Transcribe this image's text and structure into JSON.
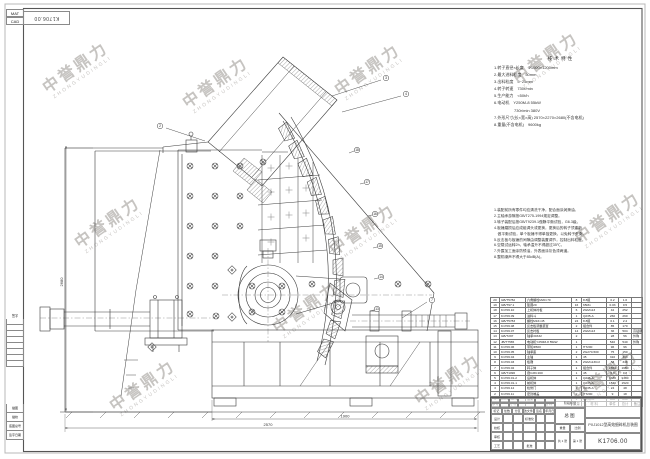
{
  "watermark": {
    "cn": "中誉鼎力",
    "en": "ZHONGYUDINGLI"
  },
  "corner": {
    "row1": "MAT",
    "row2": "CAD",
    "flipped_number": "K1706.00"
  },
  "left_margin": {
    "rev_label": "签字",
    "labels": [
      "描图",
      "描校",
      "底图总号",
      "签字日期"
    ]
  },
  "spec": {
    "title": "技术特性",
    "lines": [
      "1.转子直径×长度　Φ1000×1200mm",
      "2.最大进料粒度　50mm",
      "3.出料粒度　5~25mm",
      "4.转子转速　730r/min",
      "5.生产能力　<50t/h",
      "6.电动机　Y250M-8 55kW",
      "　　　　　730r/min  380V",
      "7.外形尺寸(长×宽×高) 2570×2270×2680(不含电机)",
      "8.重量(不含电机)　9600kg"
    ]
  },
  "notes": {
    "lines": [
      "1.装配前所有零件均应清洗干净，配合面涂润滑油。",
      "2.主轴承游隙按GB/T275-1994规定调整。",
      "3.转子装配后按GB/T9239.1做静平衡试验，G6.3级。",
      "4.板锤磨损后应成组调头或更换，更换后的转子须重新",
      "　做平衡试验，单个板锤不得单独更换，以免转子失衡。",
      "5.反击板与板锤的间隙由调整装置调节，控制出料粒度。",
      "6.空载试运转2h，轴承温升不得超过35℃。",
      "7.外露加工面涂防锈油，外表面涂灰色漆两道。",
      "8.整机噪声不得大于85dB(A)。"
    ]
  },
  "drawing": {
    "balloons": [
      "2",
      "3",
      "4",
      "18",
      "17",
      "16",
      "15",
      "14",
      "13",
      "7"
    ],
    "dims": {
      "height": "2680",
      "width": "2570",
      "inner": "1900"
    }
  },
  "bom": {
    "headers": [
      "序号",
      "代  号",
      "名  称",
      "数量",
      "材  料",
      "单件",
      "总计",
      "备注"
    ],
    "rows": [
      {
        "no": "20",
        "code": "GB/T5782",
        "name": "六角螺栓M20×70",
        "qty": "8",
        "mat": "8.8级",
        "uw": "0.2",
        "tw": "1.6",
        "rem": ""
      },
      {
        "no": "19",
        "code": "GB/T97.1",
        "name": "垫圈20",
        "qty": "16",
        "mat": "65Mn",
        "uw": "0.03",
        "tw": "0.5",
        "rem": ""
      },
      {
        "no": "18",
        "code": "K1706.10",
        "name": "上机体衬板",
        "qty": "6",
        "mat": "ZGMn13",
        "uw": "42",
        "tw": "252",
        "rem": ""
      },
      {
        "no": "17",
        "code": "K1706.09",
        "name": "进料斗",
        "qty": "1",
        "mat": "Q235-A",
        "uw": "260",
        "tw": "260",
        "rem": ""
      },
      {
        "no": "16",
        "code": "GB/T5783",
        "name": "螺栓M16×45",
        "qty": "24",
        "mat": "8.8级",
        "uw": "0.1",
        "tw": "2.4",
        "rem": ""
      },
      {
        "no": "15",
        "code": "K1706.08",
        "name": "反击板调整装置",
        "qty": "2",
        "mat": "组合件",
        "uw": "85",
        "tw": "170",
        "rem": ""
      },
      {
        "no": "14",
        "code": "K1706.07",
        "name": "反击衬板",
        "qty": "14",
        "mat": "ZGMn13",
        "uw": "36",
        "tw": "504",
        "rem": "高锰钢"
      },
      {
        "no": "13",
        "code": "GB/T297",
        "name": "轴承30332",
        "qty": "2",
        "mat": "",
        "uw": "28",
        "tw": "56",
        "rem": "外购"
      },
      {
        "no": "12",
        "code": "JB/T7565",
        "name": "电动机Y250M-8 55kW",
        "qty": "1",
        "mat": "",
        "uw": "540",
        "tw": "540",
        "rem": "外购"
      },
      {
        "no": "11",
        "code": "K1706.06",
        "name": "带轮Φ500",
        "qty": "1",
        "mat": "HT200",
        "uw": "96",
        "tw": "96",
        "rem": ""
      },
      {
        "no": "10",
        "code": "K1706.05",
        "name": "轴承座",
        "qty": "2",
        "mat": "ZG270-500",
        "uw": "75",
        "tw": "150",
        "rem": ""
      },
      {
        "no": "9",
        "code": "K1706.04",
        "name": "主轴",
        "qty": "1",
        "mat": "45",
        "uw": "310",
        "tw": "310",
        "rem": ""
      },
      {
        "no": "8",
        "code": "K1706.03",
        "name": "板锤",
        "qty": "6",
        "mat": "ZGMn13Cr2",
        "uw": "58",
        "tw": "348",
        "rem": ""
      },
      {
        "no": "7",
        "code": "K1706.02",
        "name": "转子体",
        "qty": "1",
        "mat": "组合件",
        "uw": "1650",
        "tw": "1650",
        "rem": ""
      },
      {
        "no": "6",
        "code": "GB/T1096",
        "name": "键C28×160",
        "qty": "1",
        "mat": "45",
        "uw": "0.8",
        "tw": "0.8",
        "rem": ""
      },
      {
        "no": "5",
        "code": "K1706.01-2",
        "name": "后机体",
        "qty": "1",
        "mat": "Q235-A",
        "uw": "1380",
        "tw": "1380",
        "rem": ""
      },
      {
        "no": "4",
        "code": "K1706.01-1",
        "name": "前机体",
        "qty": "1",
        "mat": "Q235-A",
        "uw": "1520",
        "tw": "1520",
        "rem": ""
      },
      {
        "no": "3",
        "code": "K1706.12",
        "name": "检修门",
        "qty": "2",
        "mat": "Q235-A",
        "uw": "24",
        "tw": "48",
        "rem": ""
      },
      {
        "no": "2",
        "code": "K1706.11",
        "name": "密封端盖",
        "qty": "2",
        "mat": "HT200",
        "uw": "9",
        "tw": "18",
        "rem": ""
      },
      {
        "no": "1",
        "code": "K1706.00-1",
        "name": "底架",
        "qty": "1",
        "mat": "Q235-A",
        "uw": "860",
        "tw": "860",
        "rem": ""
      }
    ]
  },
  "title_block": {
    "doc_type": "总图",
    "title": "PXJ1012型高效细碎机总装图",
    "number": "K1706.00",
    "stage_label": "阶段标记",
    "weight_label": "重量",
    "scale_label": "比例",
    "sheets": [
      "共 1 张",
      "第 1 张"
    ],
    "rev_headers": [
      "标记",
      "处数",
      "分区",
      "更改文件号",
      "签名",
      "年月日"
    ],
    "sig_rows": [
      {
        "a": "设计",
        "b": "标准化"
      },
      {
        "a": "校核",
        "b": ""
      },
      {
        "a": "审核",
        "b": ""
      },
      {
        "a": "工艺",
        "b": "批准"
      }
    ]
  }
}
